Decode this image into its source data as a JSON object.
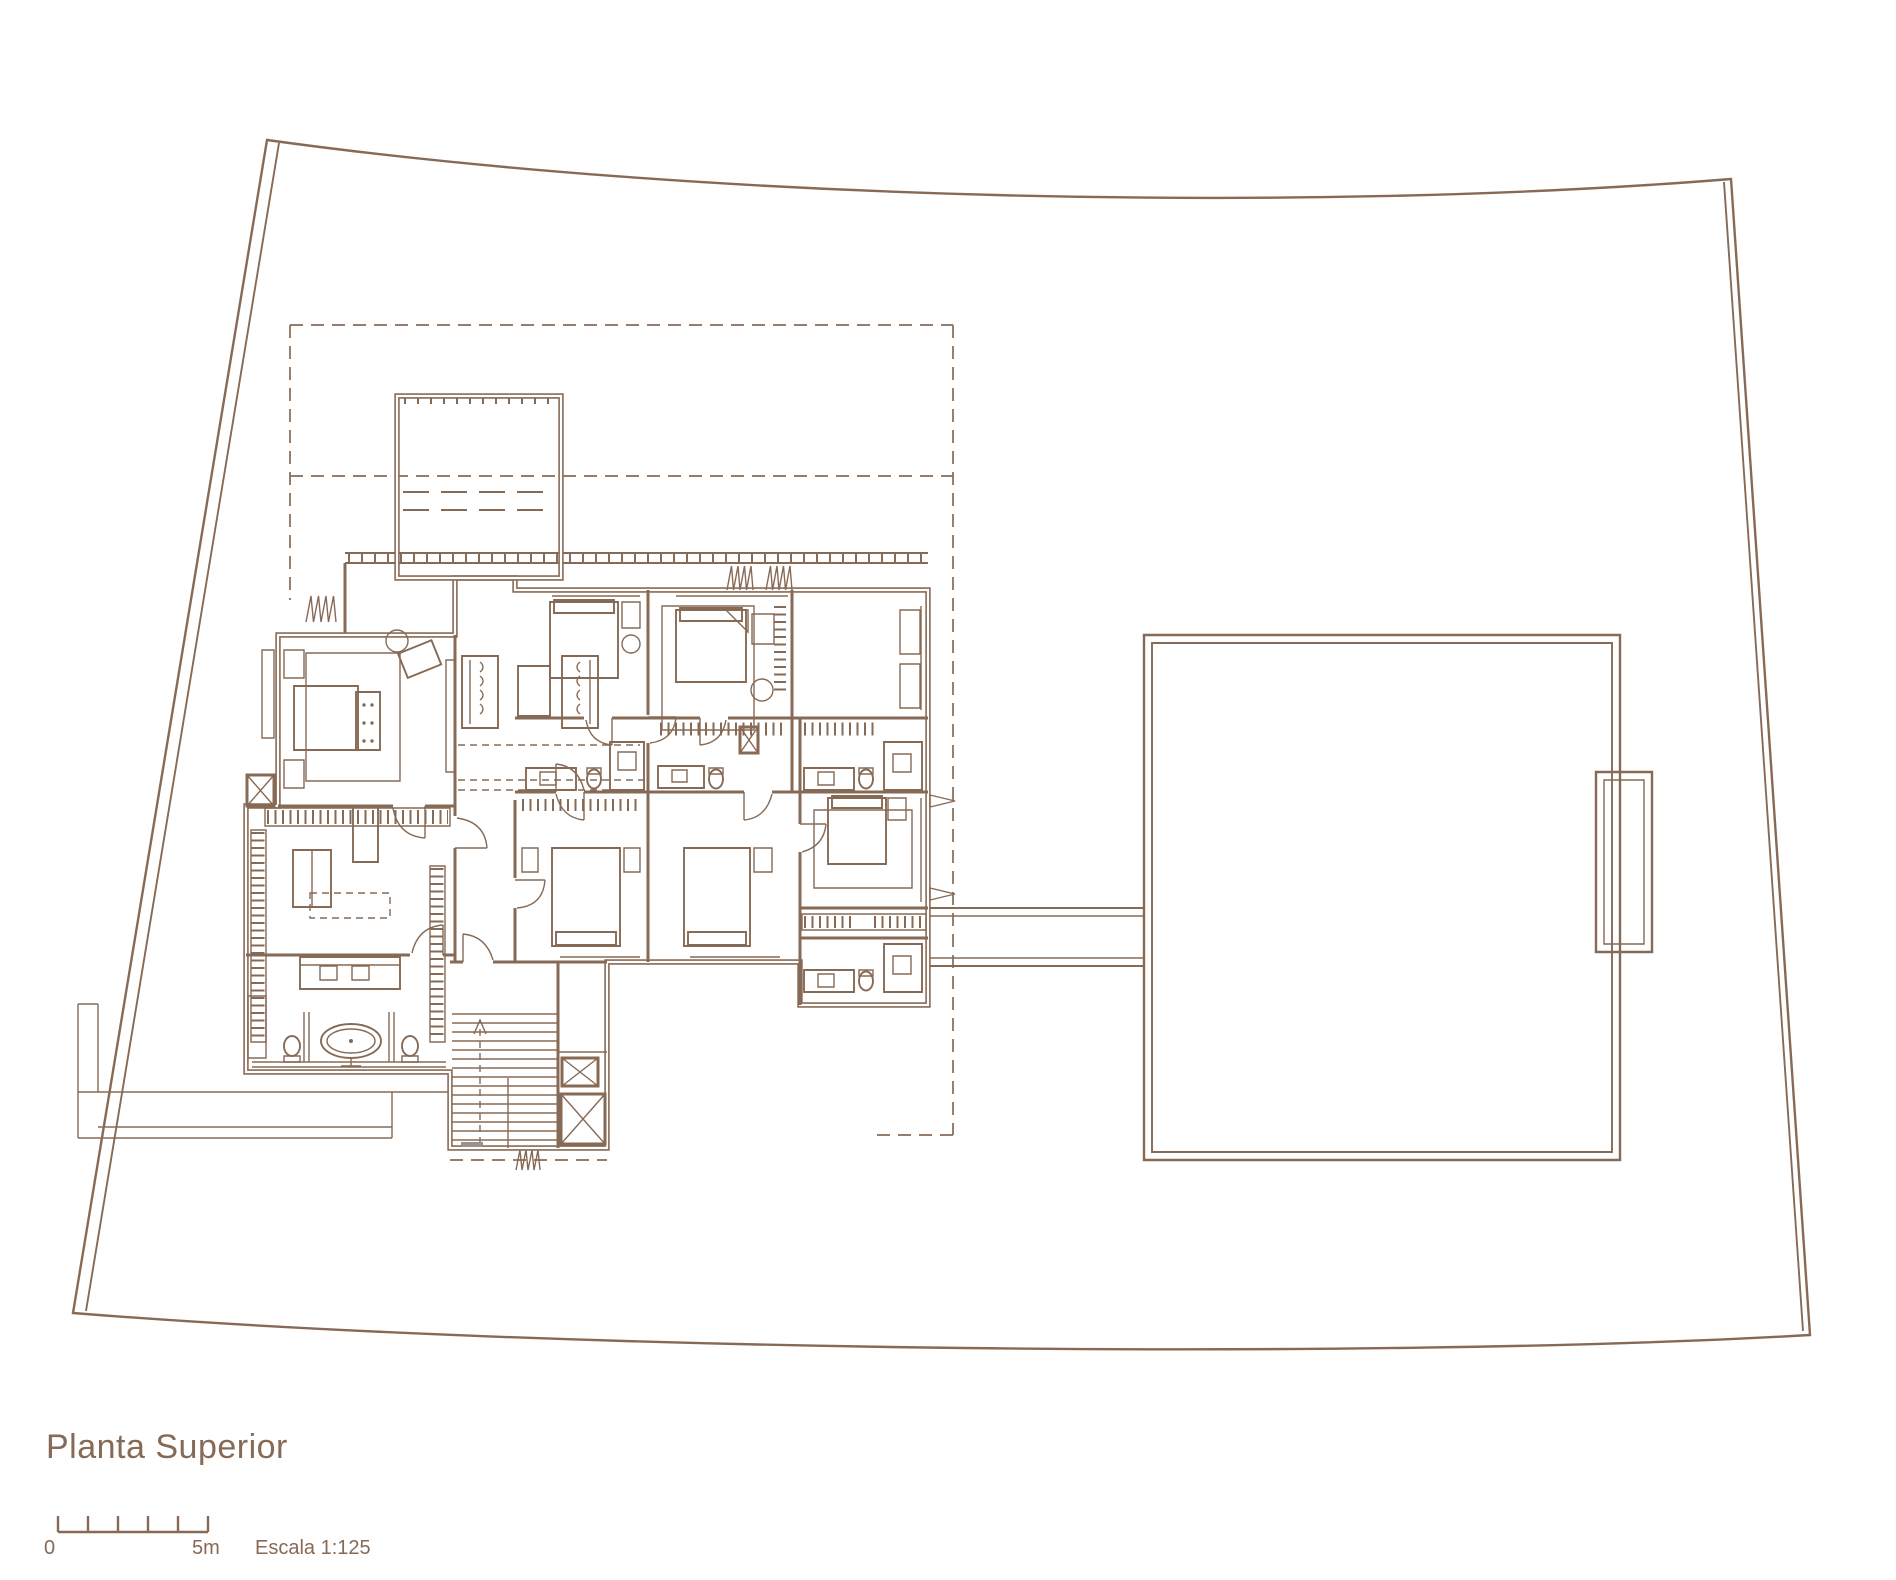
{
  "document": {
    "kind": "architectural floor plan drawing",
    "title": "Planta Superior"
  },
  "scale_bar": {
    "start_label": "0",
    "end_label": "5m",
    "scale_label": "Escala 1:125",
    "segments": 5
  },
  "colors": {
    "line": "#876a55",
    "background": "#ffffff",
    "threshold_gray": "#97938c"
  }
}
